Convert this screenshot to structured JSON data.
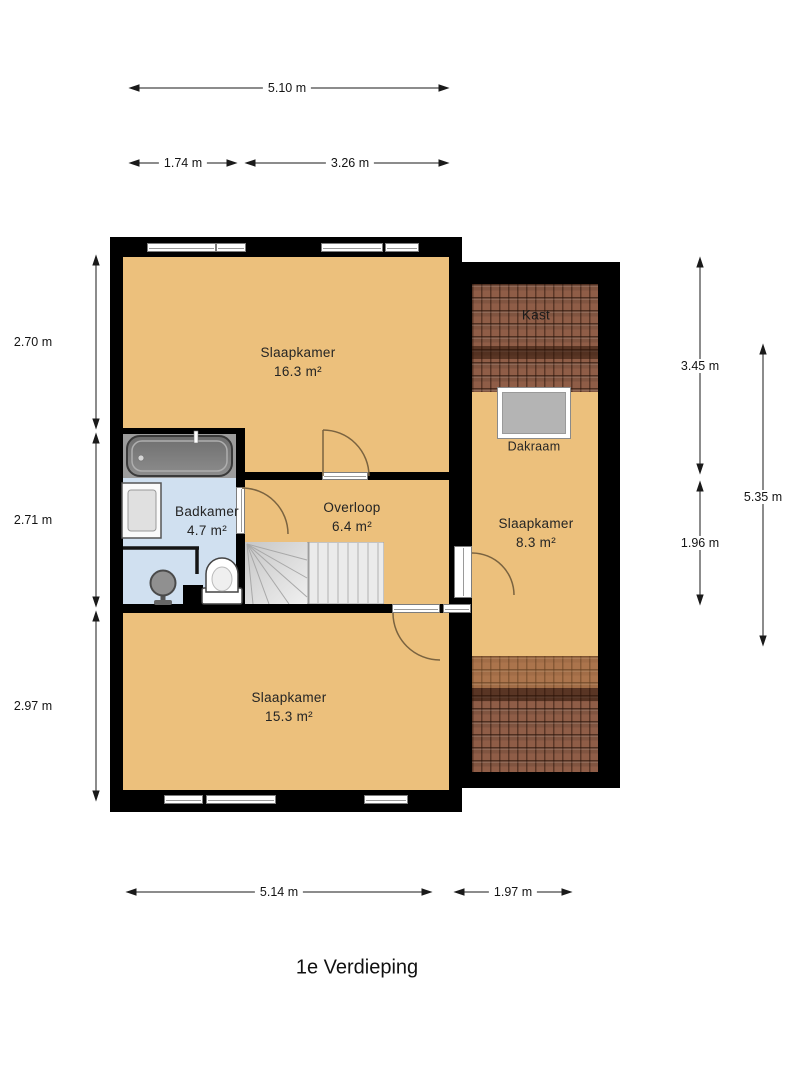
{
  "title": "1e Verdieping",
  "rooms": [
    {
      "name": "Slaapkamer",
      "area": "16.3 m²"
    },
    {
      "name": "Badkamer",
      "area": "4.7 m²"
    },
    {
      "name": "Overloop",
      "area": "6.4 m²"
    },
    {
      "name": "Slaapkamer",
      "area": "15.3 m²"
    },
    {
      "name": "Slaapkamer",
      "area": "8.3 m²"
    }
  ],
  "features": {
    "closet_label": "Kast",
    "roof_window_label": "Dakraam"
  },
  "dimensions": {
    "top": [
      {
        "label": "5.10 m"
      },
      {
        "label": "1.74 m"
      },
      {
        "label": "3.26 m"
      }
    ],
    "left": [
      {
        "label": "2.70 m"
      },
      {
        "label": "2.71 m"
      },
      {
        "label": "2.97 m"
      }
    ],
    "right": [
      {
        "label": "3.45 m"
      },
      {
        "label": "1.96 m"
      },
      {
        "label": "5.35 m"
      }
    ],
    "bottom": [
      {
        "label": "5.14 m"
      },
      {
        "label": "1.97 m"
      }
    ]
  },
  "colors": {
    "wall": "#000000",
    "floor": "#ecc07c",
    "bathroom_floor": "#d0e0f0",
    "roof_tiles": "#8f5d47",
    "stairs": "#e9e9e9",
    "background": "#ffffff"
  }
}
